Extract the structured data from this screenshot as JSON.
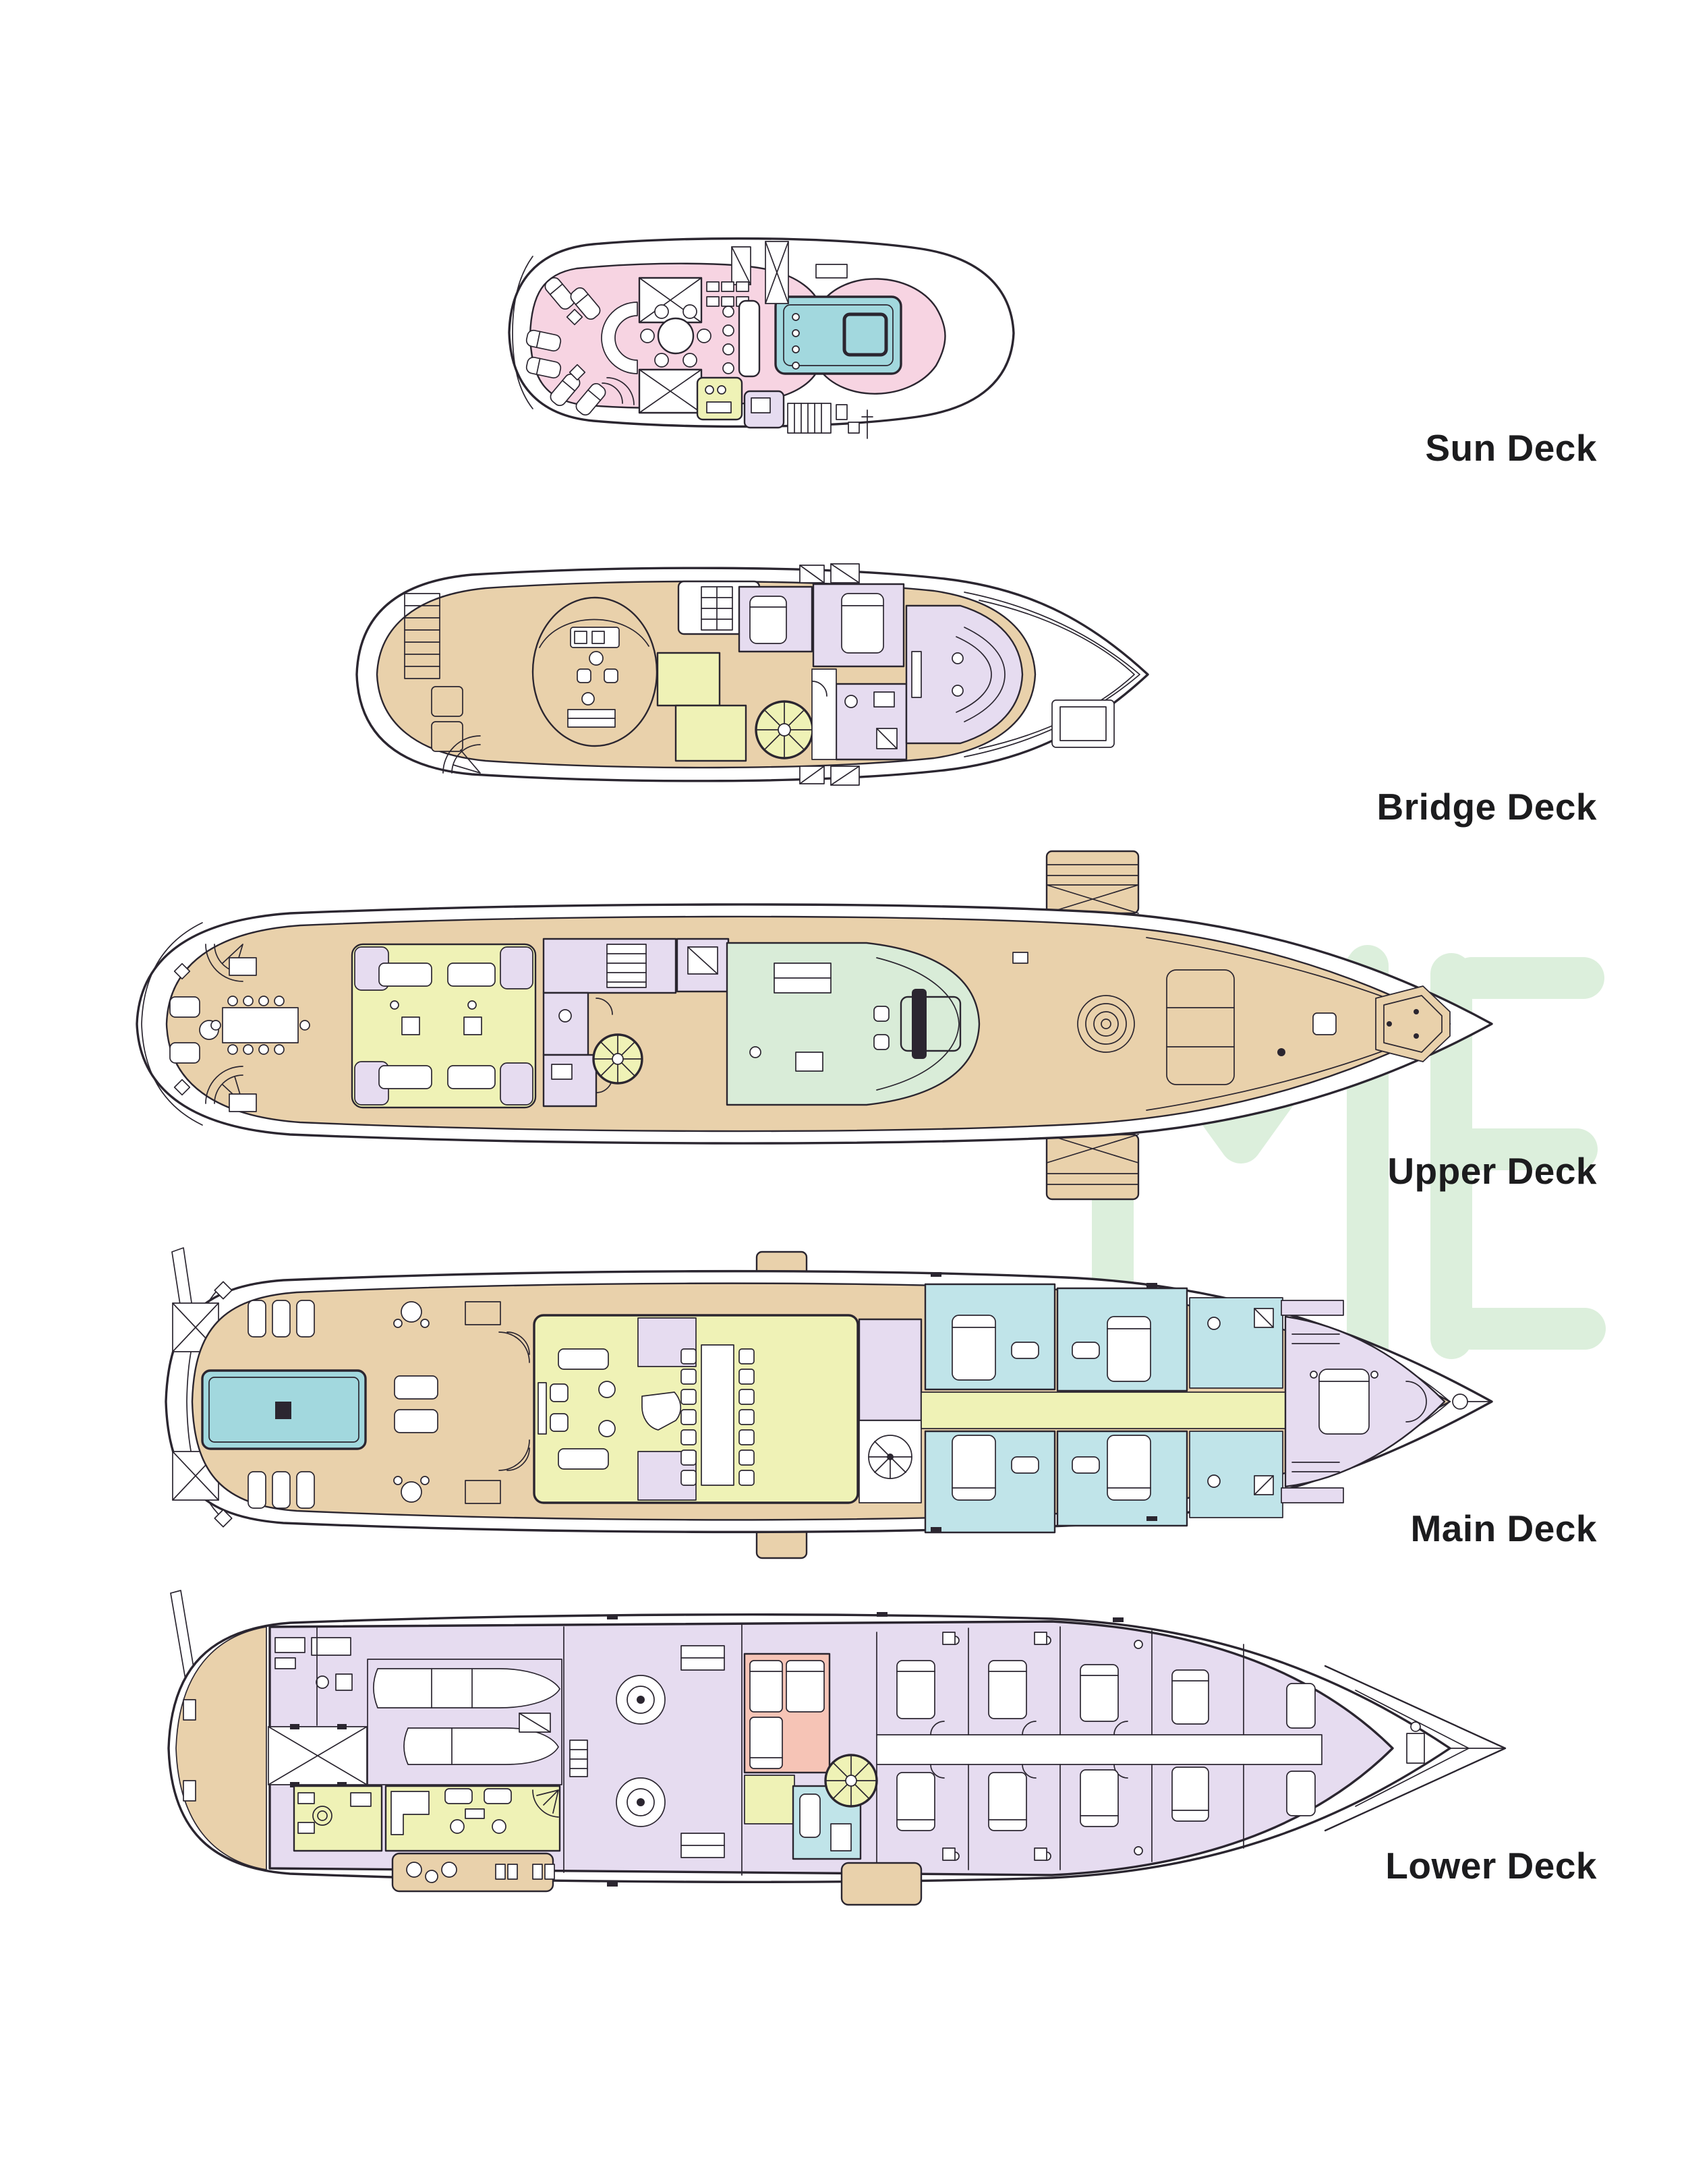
{
  "document": {
    "kind": "yacht-deck-plans-diagram",
    "background": "#ffffff",
    "label_text_color": "#1c1c1e"
  },
  "palette": {
    "line": "#2b2630",
    "pink": "#f7d4e2",
    "tan": "#e9d1ab",
    "lav": "#e6dcf0",
    "yg": "#eff2b6",
    "mint": "#d9ecd8",
    "teal": "#c0e4e9",
    "pool": "#a2d8de",
    "salmon": "#f6c4b6",
    "watermark": "#dcefdc"
  },
  "watermark": {
    "name": "light-green logo watermark",
    "color": "#dcefdc"
  },
  "decks": [
    {
      "label": "Sun Deck",
      "regions": [
        {
          "name": "sun-lounge-terrace",
          "color": "#f7d4e2"
        },
        {
          "name": "jacuzzi",
          "color": "#a2d8de"
        },
        {
          "name": "wet-bar-box",
          "color": "#eff2b6"
        },
        {
          "name": "store-box",
          "color": "#e6dcf0"
        }
      ],
      "features": [
        "sun loungers",
        "round dining table",
        "bar with stools",
        "curved sofa",
        "hatched sunpads",
        "davit"
      ]
    },
    {
      "label": "Bridge Deck",
      "regions": [
        {
          "name": "open-deck",
          "color": "#e9d1ab"
        },
        {
          "name": "captain-and-vip-cabins",
          "color": "#e6dcf0"
        },
        {
          "name": "pantry-stair-rooms",
          "color": "#eff2b6"
        },
        {
          "name": "sky-lounge",
          "color": "#e6dcf0"
        }
      ],
      "features": [
        "wheelhouse oval",
        "spiral staircase",
        "aft railing",
        "foredeck hatch",
        "anchor capstans"
      ]
    },
    {
      "label": "Upper Deck",
      "regions": [
        {
          "name": "open-deck",
          "color": "#e9d1ab"
        },
        {
          "name": "upper-salon",
          "color": "#eff2b6"
        },
        {
          "name": "cabins",
          "color": "#e6dcf0"
        },
        {
          "name": "bridge-room",
          "color": "#d9ecd8"
        }
      ],
      "features": [
        "side boarding platforms",
        "aft dining table",
        "spiral staircases",
        "mooring winch",
        "foredeck sunpad",
        "bow bench"
      ]
    },
    {
      "label": "Main Deck",
      "regions": [
        {
          "name": "aft-deck",
          "color": "#e9d1ab"
        },
        {
          "name": "swimming-pool",
          "color": "#a2d8de"
        },
        {
          "name": "main-salon",
          "color": "#eff2b6"
        },
        {
          "name": "day-heads-foyer",
          "color": "#e6dcf0"
        },
        {
          "name": "guest-cabins",
          "color": "#c0e4e9"
        },
        {
          "name": "corridor",
          "color": "#eff2b6"
        },
        {
          "name": "owner-suite",
          "color": "#e6dcf0"
        }
      ],
      "features": [
        "mast",
        "sun lounger rows",
        "long dining table",
        "piano",
        "spiral staircase",
        "king beds",
        "bow winch"
      ]
    },
    {
      "label": "Lower Deck",
      "regions": [
        {
          "name": "swim-platform",
          "color": "#e9d1ab"
        },
        {
          "name": "tender-garage",
          "color": "#e6dcf0"
        },
        {
          "name": "laundry",
          "color": "#eff2b6"
        },
        {
          "name": "crew-mess",
          "color": "#eff2b6"
        },
        {
          "name": "engine-room",
          "color": "#e6dcf0"
        },
        {
          "name": "crew-cabins",
          "color": "#f6c4b6"
        },
        {
          "name": "stair-lobby",
          "color": "#c0e4e9"
        },
        {
          "name": "guest-cabins",
          "color": "#e6dcf0"
        },
        {
          "name": "side-platforms",
          "color": "#e9d1ab"
        }
      ],
      "features": [
        "two tenders",
        "crane hatch with X brace",
        "engines",
        "bunk beds",
        "spiral staircase",
        "layered bow chevrons"
      ]
    }
  ]
}
